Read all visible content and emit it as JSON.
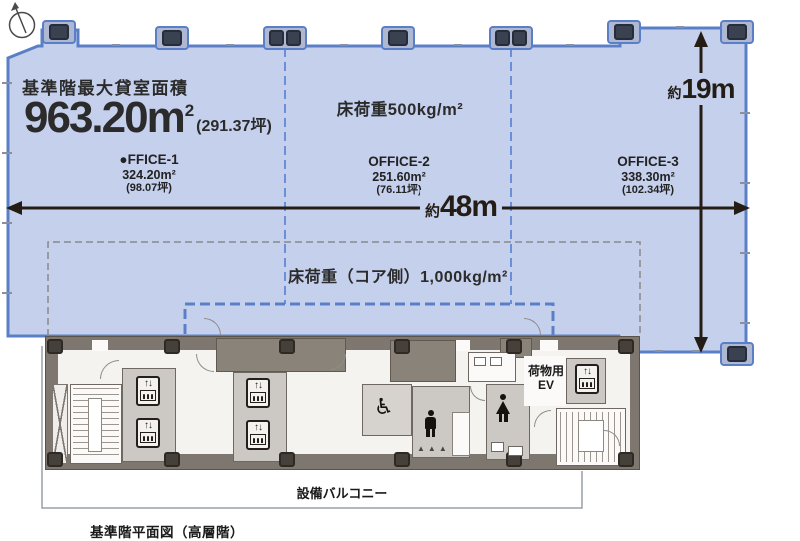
{
  "header": {
    "title": "基準階最大貸室面積",
    "area_value": "963.20",
    "area_unit": "m",
    "area_unit_sup": "2",
    "area_tsubo": "(291.37坪)"
  },
  "loads": {
    "office_zone": "床荷重500kg/m²",
    "core_zone": "床荷重（コア側）1,000kg/m²"
  },
  "offices": [
    {
      "name": "●FFICE-1",
      "area": "324.20m²",
      "tsubo": "(98.07坪)"
    },
    {
      "name": "OFFICE-2",
      "area": "251.60m²",
      "tsubo": "(76.11坪)"
    },
    {
      "name": "OFFICE-3",
      "area": "338.30m²",
      "tsubo": "(102.34坪)"
    }
  ],
  "dimensions": {
    "width_prefix": "約",
    "width_value": "48m",
    "depth_prefix": "約",
    "depth_value": "19m"
  },
  "core_labels": {
    "freight_ev_line1": "荷物用",
    "freight_ev_line2": "EV",
    "balcony": "設備バルコニー"
  },
  "caption": "基準階平面図（高層階）",
  "icons": {
    "elevator_arrows": "↑↓",
    "wheelchair": "♿",
    "urinal_row": "▲▲▲"
  },
  "colors": {
    "tenant_fill": "#c5d0ed",
    "tenant_border": "#5b7fc6",
    "partition_dash": "#6b8fd6",
    "core_load_dash": "#8a8a8a",
    "wall": "#6f6862",
    "room_light": "#ccc8c3",
    "room_dark": "#8a8379",
    "column": "#3a4252",
    "text": "#222222"
  }
}
